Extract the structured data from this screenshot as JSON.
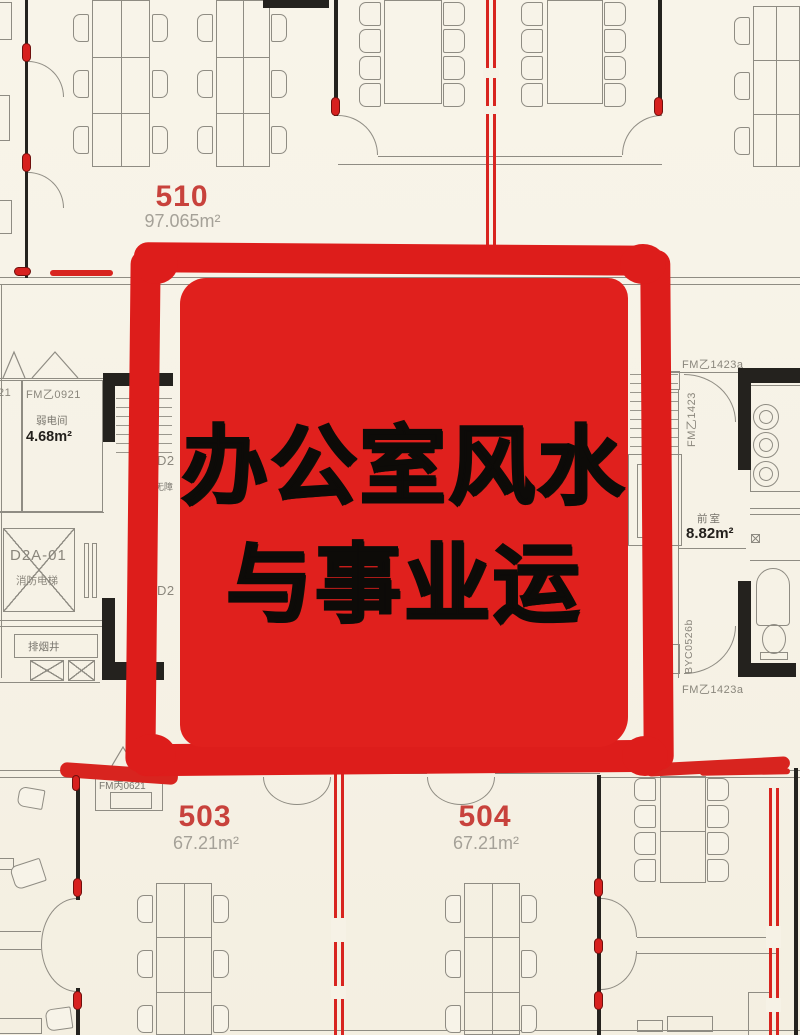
{
  "stamp": {
    "line1": "办公室风水",
    "line2": "与事业运"
  },
  "rooms": {
    "room510": {
      "number": "510",
      "area": "97.065m²"
    },
    "room503": {
      "number": "503",
      "area": "67.21m²"
    },
    "room504": {
      "number": "504",
      "area": "67.21m²"
    }
  },
  "labels": {
    "fm0921": "FM乙0921",
    "weak_room": "弱电间",
    "weak_area": "4.68m²",
    "partial_left": "21",
    "elevator_id": "D2A-01",
    "elevator_name": "消防电梯",
    "smoke_shaft": "排烟井",
    "fm0621": "FM丙0621",
    "fm1423a_top": "FM乙1423a",
    "fm1423_side": "FM乙1423",
    "front_room": "前室",
    "front_area": "8.82m²",
    "byc": "BYC0526b",
    "fm1423a_bottom": "FM乙1423a",
    "shaft_chars": "梯加送",
    "d2_upper": "D2",
    "accessible_partial": "无障",
    "d2_lower": "D2"
  },
  "colors": {
    "stamp_red": "#dd1d1b",
    "trace_red": "#d8241f",
    "room_number_red": "#c8423c",
    "line_gray": "#8f8c83",
    "area_gray": "#a5a198",
    "background": "#f6f2e6"
  }
}
